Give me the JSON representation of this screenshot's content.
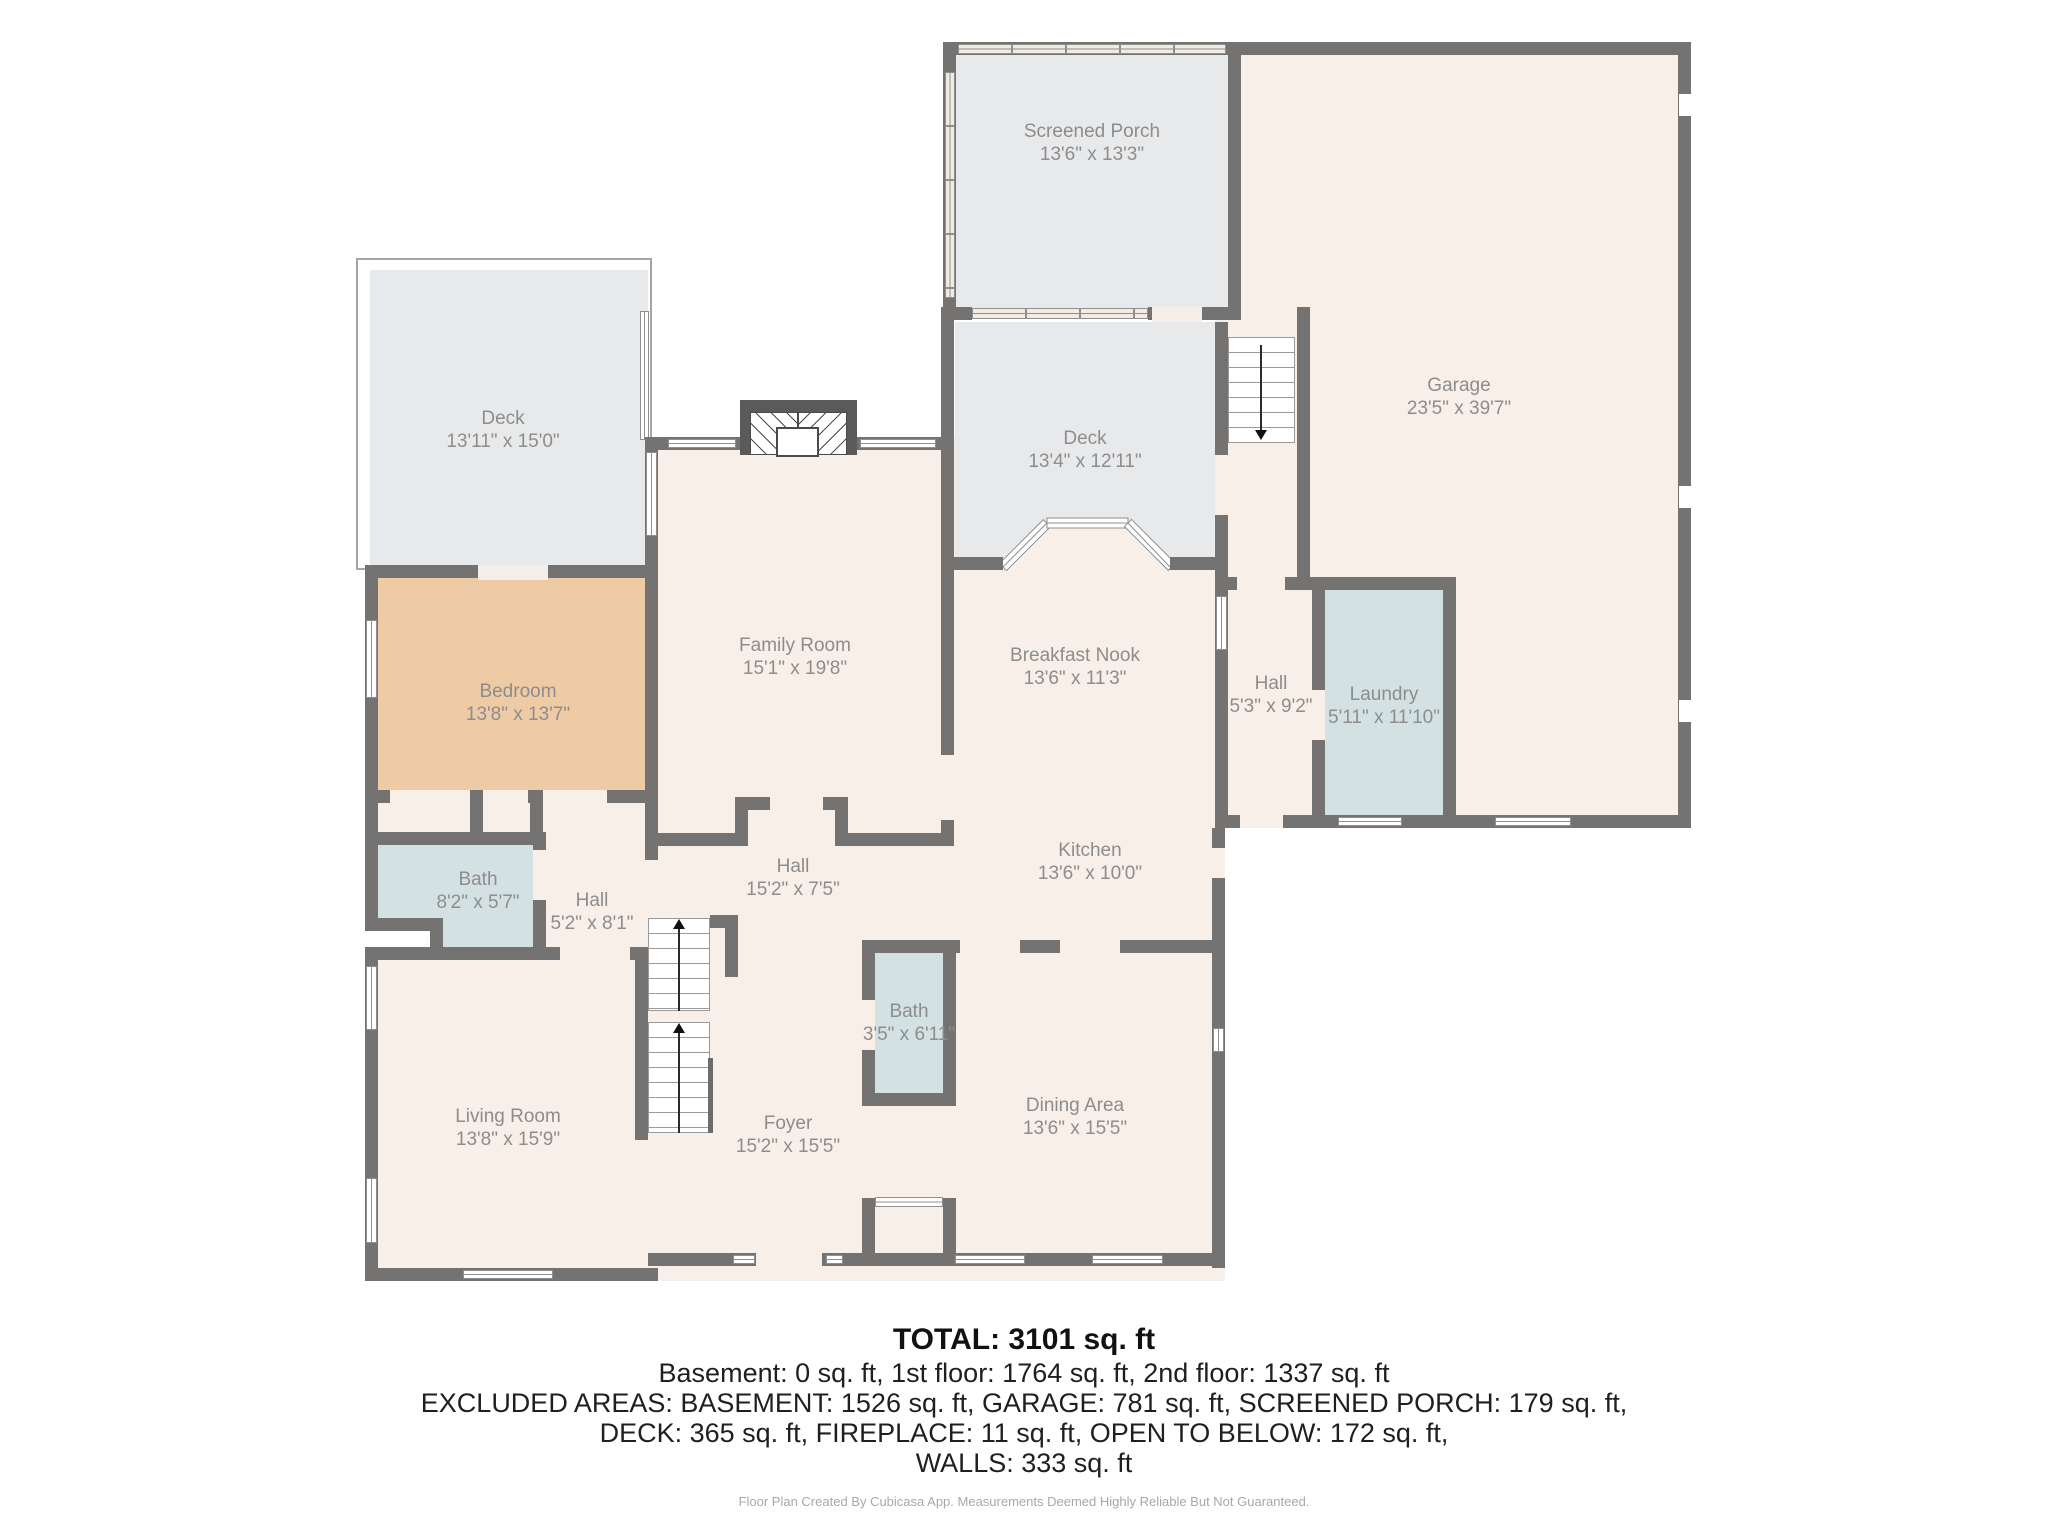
{
  "plan": {
    "rooms": {
      "screened_porch": {
        "name": "Screened Porch",
        "dims": "13'6\" x 13'3\""
      },
      "garage": {
        "name": "Garage",
        "dims": "23'5\" x 39'7\""
      },
      "deck_left": {
        "name": "Deck",
        "dims": "13'11\" x 15'0\""
      },
      "deck_middle": {
        "name": "Deck",
        "dims": "13'4\" x 12'11\""
      },
      "family_room": {
        "name": "Family Room",
        "dims": "15'1\" x 19'8\""
      },
      "breakfast_nook": {
        "name": "Breakfast Nook",
        "dims": "13'6\" x 11'3\""
      },
      "hall_garage": {
        "name": "Hall",
        "dims": "5'3\" x 9'2\""
      },
      "laundry": {
        "name": "Laundry",
        "dims": "5'11\" x 11'10\""
      },
      "bedroom": {
        "name": "Bedroom",
        "dims": "13'8\" x 13'7\""
      },
      "bath_main": {
        "name": "Bath",
        "dims": "8'2\" x 5'7\""
      },
      "hall_bedroom": {
        "name": "Hall",
        "dims": "5'2\" x 8'1\""
      },
      "hall_center": {
        "name": "Hall",
        "dims": "15'2\" x 7'5\""
      },
      "kitchen": {
        "name": "Kitchen",
        "dims": "13'6\" x 10'0\""
      },
      "bath_center": {
        "name": "Bath",
        "dims": "3'5\" x 6'11\""
      },
      "living_room": {
        "name": "Living Room",
        "dims": "13'8\" x 15'9\""
      },
      "foyer": {
        "name": "Foyer",
        "dims": "15'2\" x 15'5\""
      },
      "dining_area": {
        "name": "Dining Area",
        "dims": "13'6\" x 15'5\""
      }
    },
    "colors": {
      "wall": "#757372",
      "floor": "#f7efe8",
      "deck": "#e8e9eb",
      "bedroom": "#eecaa5",
      "wet_room": "#d3e1e3",
      "label_text": "#8d8d8d"
    }
  },
  "summary": {
    "total": "TOTAL: 3101 sq. ft",
    "floors": "Basement: 0 sq. ft, 1st floor: 1764 sq. ft, 2nd floor: 1337 sq. ft",
    "excluded_1": "EXCLUDED AREAS: BASEMENT: 1526 sq. ft, GARAGE: 781 sq. ft, SCREENED PORCH: 179 sq. ft,",
    "excluded_2": "DECK: 365 sq. ft, FIREPLACE: 11 sq. ft, OPEN TO BELOW: 172 sq. ft,",
    "excluded_3": "WALLS: 333 sq. ft"
  },
  "footer": "Floor Plan Created By Cubicasa App. Measurements Deemed Highly Reliable But Not Guaranteed."
}
